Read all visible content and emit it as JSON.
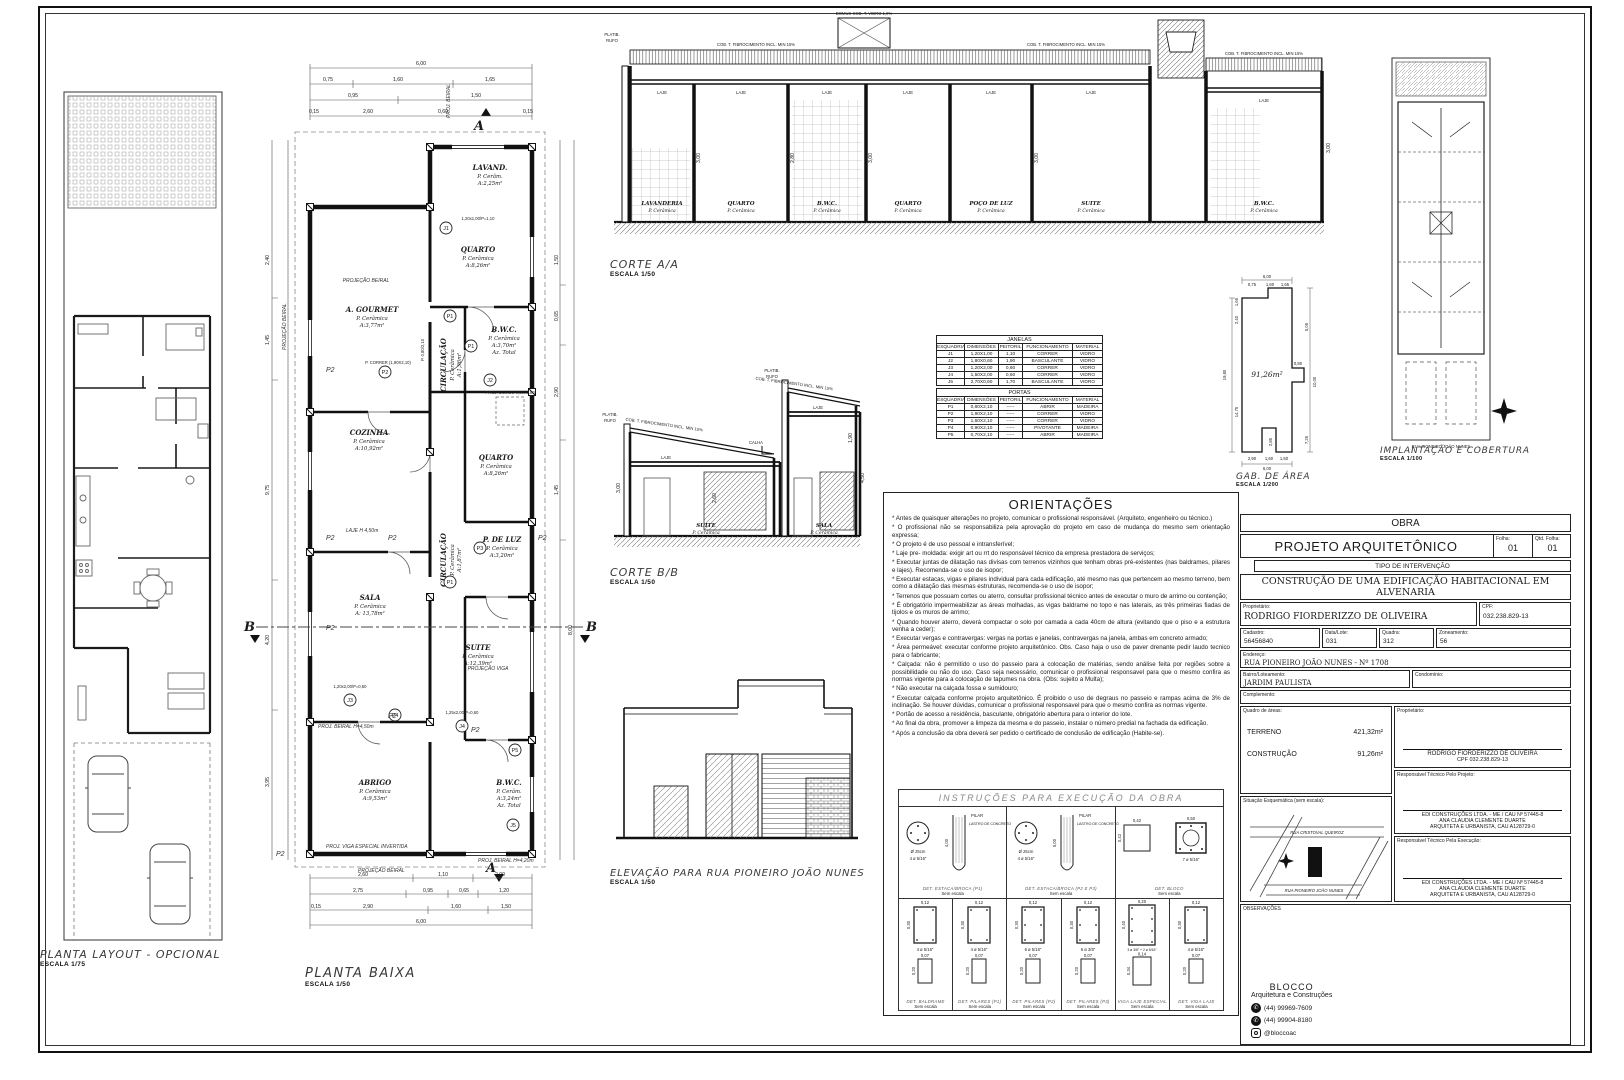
{
  "planta_layout": {
    "title": "PLANTA LAYOUT - OPCIONAL",
    "scale": "ESCALA 1/75"
  },
  "planta_baixa": {
    "title": "PLANTA BAIXA",
    "scale": "ESCALA 1/50",
    "rooms": [
      {
        "name": "LAVAND.",
        "floor": "P. Cerâm.",
        "area": "A:2,25m²",
        "extra": ""
      },
      {
        "name": "QUARTO",
        "floor": "P. Cerâmica",
        "area": "A:8,26m²",
        "extra": ""
      },
      {
        "name": "B.W.C.",
        "floor": "P. Cerâmica",
        "area": "A:3,70m²",
        "extra": "Az. Total"
      },
      {
        "name": "A. GOURMET",
        "floor": "P. Cerâmica",
        "area": "A:3,77m²",
        "extra": ""
      },
      {
        "name": "CIRCULAÇÃO",
        "floor": "P. Cerâmica",
        "area": "A:1,96m²",
        "extra": ""
      },
      {
        "name": "COZINHA",
        "floor": "P. Cerâmica",
        "area": "A:10,92m²",
        "extra": ""
      },
      {
        "name": "QUARTO",
        "floor": "P. Cerâmica",
        "area": "A:8,26m²",
        "extra": ""
      },
      {
        "name": "CIRCULAÇÃO",
        "floor": "P. Cerâmica",
        "area": "A:1,87m²",
        "extra": ""
      },
      {
        "name": "P. DE LUZ",
        "floor": "P. Cerâmica",
        "area": "A:3,20m²",
        "extra": ""
      },
      {
        "name": "SALA",
        "floor": "P. Cerâmica",
        "area": "A: 13,78m²",
        "extra": ""
      },
      {
        "name": "SUITE",
        "floor": "P. Cerâmica",
        "area": "A:12,39m²",
        "extra": ""
      },
      {
        "name": "ABRIGO",
        "floor": "P. Cerâmica",
        "area": "A:9,53m²",
        "extra": ""
      },
      {
        "name": "B.W.C.",
        "floor": "P. Cerâm.",
        "area": "A:3,24m²",
        "extra": "Az. Total"
      }
    ],
    "tags": [
      "J1",
      "P1",
      "P1",
      "J2",
      "P2",
      "P1",
      "P3",
      "J3",
      "P4",
      "J4",
      "P5",
      "J5"
    ],
    "ann": {
      "projecao_beiral": "PROJEÇÃO BEIRAL",
      "proj_beiral": "PROJ. BEIRAL",
      "proj_beiral_h450": "PROJ. BEIRAL H=4,50m",
      "proj_beiral_h420": "PROJ. BEIRAL H=4,20m",
      "laje_h": "LAJE H 4,50m",
      "projecao_viga": "PROJEÇÃO VIGA",
      "viga_inv": "PROJ. VIGA ESPECIAL INVERTIDA",
      "proj_domus": "PROJ. DOMUS 0,80X0,80",
      "p2": "P2",
      "b": "B",
      "a": "A",
      "w1": "1,20x1,00/P=1,10",
      "w2": "P. 0,80/2,10",
      "w3": "P. CORRER (1,90X2,10)",
      "w4": "1,20x2,00/P=0,60",
      "w5": "1,25x2,00/P=0,60"
    },
    "dims_top": [
      "6,00",
      "0,75",
      "1,60",
      "1,65",
      "0,95",
      "1,50",
      "0,15",
      "2,60",
      "0,60"
    ],
    "dims_bottom": [
      "2,60",
      "1,10",
      "2,00",
      "2,75",
      "0,95",
      "0,65",
      "1,20",
      "2,90",
      "1,60",
      "1,50",
      "6,00",
      "0,15"
    ],
    "dims_left": [
      "2,40",
      "1,45",
      "9,75",
      "4,20",
      "3,95"
    ],
    "dims_right": [
      "1,50",
      "0,65",
      "2,90",
      "1,45",
      "8,00"
    ]
  },
  "corte_aa": {
    "title": "CORTE A/A",
    "scale": "ESCALA 1/50",
    "cob": "COB. T. FIBROCIMENTO INCL. MIN 15%",
    "domus": "DOMUS COB. T. VIDRO 1,0%",
    "laje": "LAJE",
    "platib": "PLATIB.",
    "rufo": "RUFO",
    "rooms": [
      {
        "name": "LAVANDERIA",
        "floor": "P. Cerâmica"
      },
      {
        "name": "QUARTO",
        "floor": "P. Cerâmica"
      },
      {
        "name": "B.W.C.",
        "floor": "P. Cerâmica"
      },
      {
        "name": "QUARTO",
        "floor": "P. Cerâmica"
      },
      {
        "name": "POÇO DE LUZ",
        "floor": "P. Cerâmica"
      },
      {
        "name": "SUITE",
        "floor": "P. Cerâmica"
      },
      {
        "name": "B.W.C.",
        "floor": "P. Cerâmica"
      }
    ],
    "dims": [
      "3,00",
      "2,80",
      "3,00",
      "3,00",
      "3,00"
    ]
  },
  "corte_bb": {
    "title": "CORTE B/B",
    "scale": "ESCALA 1/50",
    "cob": "COB. T. FIBROCIMENTO INCL. MIN 15%",
    "laje": "LAJE",
    "calha": "CALHA",
    "platib": "PLATIB.",
    "rufo": "RUFO",
    "rooms": [
      {
        "name": "SUITE",
        "floor": "P. Cerâmica"
      },
      {
        "name": "SALA",
        "floor": "P. Cerâmica"
      }
    ],
    "dims": [
      "3,00",
      "2,60",
      "1,90",
      "4,50"
    ]
  },
  "elevacao": {
    "title": "ELEVAÇÃO PARA RUA PIONEIRO JOÃO NUNES",
    "scale": "ESCALA 1/50"
  },
  "tables": {
    "janelas": {
      "title": "JANELAS",
      "headers": [
        "ESQUADRIA",
        "DIMENSÕES",
        "PEITORIL",
        "FUNCIONAMENTO",
        "MATERIAL"
      ],
      "rows": [
        [
          "J1",
          "1,20X1,00",
          "1,10",
          "CORRER",
          "VIDRO"
        ],
        [
          "J2",
          "1,80X0,60",
          "1,90",
          "BASCULANTE",
          "VIDRO"
        ],
        [
          "J3",
          "1,20X2,00",
          "0,60",
          "CORRER",
          "VIDRO"
        ],
        [
          "J4",
          "1,50X2,00",
          "0,60",
          "CORRER",
          "VIDRO"
        ],
        [
          "J5",
          "2,70X0,60",
          "1,70",
          "BASCULANTE",
          "VIDRO"
        ]
      ]
    },
    "portas": {
      "title": "PORTAS",
      "headers": [
        "ESQUADRIA",
        "DIMENSÕES",
        "PEITORIL",
        "FUNCIONAMENTO",
        "MATERIAL"
      ],
      "rows": [
        [
          "P1",
          "0,80X2,10",
          "-----",
          "ABRIR",
          "MADEIRA"
        ],
        [
          "P2",
          "1,90X2,10",
          "-----",
          "CORRER",
          "VIDRO"
        ],
        [
          "P3",
          "1,60X2,10",
          "-----",
          "CORRER",
          "VIDRO"
        ],
        [
          "P4",
          "0,90X2,10",
          "-----",
          "PIVOTANTE",
          "MADEIRA"
        ],
        [
          "P5",
          "0,70X2,10",
          "-----",
          "ABRIR",
          "MADEIRA"
        ]
      ]
    }
  },
  "gab_area": {
    "title": "GAB. DE ÁREA",
    "scale": "ESCALA 1/200",
    "area": "91,26m²",
    "dims": {
      "top_total": "6,00",
      "t1": "0,75",
      "t2": "1,60",
      "t3": "1,65",
      "left_total": "19,80",
      "l1": "2,40",
      "l2": "1,65",
      "l3": "14,75",
      "r1": "5,05",
      "r2": "10,00",
      "r3": "7,25",
      "b1": "2,90",
      "b2": "1,60",
      "b3": "1,50",
      "bottom_total": "6,00",
      "n1": "0,80",
      "n2": "2,85"
    }
  },
  "implantacao": {
    "title": "IMPLANTAÇÃO E COBERTURA",
    "scale": "ESCALA 1/100",
    "street": "RUA PIONEIRO JOÃO NUNES"
  },
  "orientacoes": {
    "title": "ORIENTAÇÕES",
    "items": [
      "* Antes de quaisquer alterações no projeto, comunicar o profissional responsável. (Arquiteto, engenheiro ou técnico.)",
      "* O profissional não se responsabiliza pela aprovação do projeto em caso de mudança do mesmo sem orientação expressa;",
      "* O projeto é de uso pessoal e intransferível;",
      "* Laje pre- moldada: exigir art ou rrt do responsável técnico da empresa prestadora de serviços;",
      "* Executar juntas de dilatação nas divisas com terrenos vizinhos que tenham obras pré-existentes (nas baldrames, pilares e lajes). Recomenda-se o uso de isopor;",
      "* Executar estacas, vigas e pilares individual para cada edificação, até mesmo nas que pertencem ao mesmo terreno, bem como a dilatação das mesmas estruturas, recomenda-se o uso de isopor;",
      "* Terrenos que possuam cortes ou aterro, consultar profissional técnico antes de executar o muro de arrimo ou contenção;",
      "* É obrigatório impermeabilizar as áreas molhadas, as vigas baldrame no topo e nas laterais, as três primeiras fiadas de tijolos e os muros de arrimo;",
      "* Quando houver aterro, deverá compactar o solo por camada a cada 40cm de altura (evitando que o piso e a estrutura venha a ceder);",
      "* Executar vergas e contravergas: vergas na portas e janelas, contravergas na janela, ambas em concreto armado;",
      "* Área permeável: executar conforme projeto arquitetônico. Obs. Caso haja o uso de paver drenante pedir laudo tecnico para o fabricante;",
      "* Calçada: não é permitido o uso do passeio para a colocação de matérias, sendo análise feita por regiões sobre a possibilidade ou não do uso. Caso seja necessário, comunicar o profissional responsavel para que o mesmo confira as normas vigente para a colocação de tapumes na obra. (Obs: sujeito a Multa);",
      "* Não executar na calçada fossa e sumidouro;",
      "* Executar calçada conforme projeto arquitetônico. É proibido o uso de degraus no passeio e rampas acima de 3% de inclinação. Se houver dúvidas, comunicar o profissional responsavel para que o mesmo confira as normas vigente.",
      "* Portão de acesso a residência, basculante, obrigatório abertura para o interior do lote.",
      "* Ao final da obra, promover a limpeza da mesma e do passeio, instalar o número predial na fachada da edificação.",
      "* Após a conclusão da obra deverá ser pedido o certificado de conclusão de edificação (Habite-se)."
    ]
  },
  "instrucoes": {
    "title": "INSTRUÇÕES PARA EXECUÇÃO DA OBRA",
    "sem_escala": "Sem escala",
    "estaca1": {
      "diam": "Ø 25cm",
      "rebar": "4 ø 5/16\"",
      "pilar": "PILAR",
      "lastro": "LASTRO DE CONCRETO",
      "dim": "4,00",
      "label": "DET. ESTACA/BROCA (P1)"
    },
    "estaca2": {
      "diam": "Ø 25cm",
      "rebar": "4 ø 5/16\"",
      "pilar": "PILAR",
      "lastro": "LASTRO DE CONCRETO",
      "dim": "5,00",
      "label": "DET. ESTACA/BROCA (P2 E P3)"
    },
    "bloco": {
      "d1": "0,42",
      "d2": "0,42",
      "d3": "0,50",
      "rebar": "7 ø 5/16\"",
      "label": "DET. BLOCO"
    },
    "pilares": [
      {
        "w": "0,12",
        "h": "0,30",
        "rebar": "4 ø 5/16\"",
        "bw": "0,07",
        "bh": "0,20",
        "label": "DET. BALDRAME"
      },
      {
        "w": "0,12",
        "h": "0,30",
        "rebar": "4 ø 5/16\"",
        "bw": "0,07",
        "bh": "0,20",
        "label": "DET. PILARES (P1)"
      },
      {
        "w": "0,12",
        "h": "0,30",
        "rebar": "6 ø 5/16\"",
        "bw": "0,07",
        "bh": "0,20",
        "label": "DET. PILARES (P2)"
      },
      {
        "w": "0,12",
        "h": "0,30",
        "rebar": "6 ø 3/8\"",
        "bw": "0,07",
        "bh": "0,20",
        "label": "DET. PILARES (P3)"
      },
      {
        "w": "0,20",
        "h": "0,40",
        "rebar": "3 ø 3/8\" + 2 ø 5/16\"",
        "bw": "0,14",
        "bh": "0,34",
        "label": "VIGA LAJE ESPECIAL"
      },
      {
        "w": "0,12",
        "h": "0,30",
        "rebar": "4 ø 5/16\"",
        "bw": "0,07",
        "bh": "0,20",
        "label": "DET. VIGA LAJE"
      }
    ]
  },
  "titleblock": {
    "obra": "OBRA",
    "projeto": "PROJETO ARQUITETÔNICO",
    "folha_label": "Folha:",
    "folha": "01",
    "qtd_label": "Qtd. Folha:",
    "qtd": "01",
    "tipo": "TIPO DE INTERVENÇÃO",
    "descricao": "CONSTRUÇÃO DE UMA EDIFICAÇÃO HABITACIONAL EM ALVENARIA",
    "proprietario_label": "Proprietário:",
    "proprietario": "RODRIGO FIORDERIZZO DE OLIVEIRA",
    "cpf_label": "CPF:",
    "cpf": "032.238.829-13",
    "cadastro_label": "Cadastro:",
    "cadastro": "56456840",
    "lote_label": "Data/Lote:",
    "lote": "031",
    "quadra_label": "Quadra:",
    "quadra": "312",
    "zoneamento_label": "Zoneamento:",
    "zoneamento": "56",
    "endereco_label": "Endereço:",
    "endereco": "RUA PIONEIRO JOÃO NUNES - Nº 1708",
    "bairro_label": "Bairro/Loteamento:",
    "bairro": "JARDIM PAULISTA",
    "condominio_label": "Condomínio:",
    "complemento_label": "Complemento:",
    "quadro_label": "Quadro de áreas:",
    "terreno_label": "TERRENO",
    "terreno": "421,32m²",
    "construcao_label": "CONSTRUÇÃO",
    "construcao": "91,26m²",
    "prop_sig_label": "Proprietário:",
    "prop_sig_name": "RODRIGO FIORDERIZZO DE OLIVEIRA",
    "prop_sig_cpf": "CPF 032.238.829-13",
    "resp_proj_label": "Responsável Técnico Pelo Projeto:",
    "resp_line1": "EDI CONSTRUÇÕES LTDA. - ME / CAU Nº 57445-8",
    "resp_line2": "ANA CLAUDIA CLEMENTE DUARTE",
    "resp_line3": "ARQUITETA E URBANISTA, CAU A128729-0",
    "resp_exec_label": "Responsável Técnico Pela Execução:",
    "situacao_label": "Situação Esquemática (sem escala):",
    "map_street_top": "RUA CRISTOVAL QUEIROZ",
    "map_street_bottom": "RUA PIONEIRO JOÃO NUNES",
    "observacoes_label": "OBSERVAÇÕES",
    "brand": "BLOCCO",
    "brand_sub": "Arquitetura e Construções",
    "whatsapp_icon": "✆",
    "phone1": "(44) 99969-7609",
    "phone2": "(44) 99904-8180",
    "instagram": "@bloccoac"
  }
}
